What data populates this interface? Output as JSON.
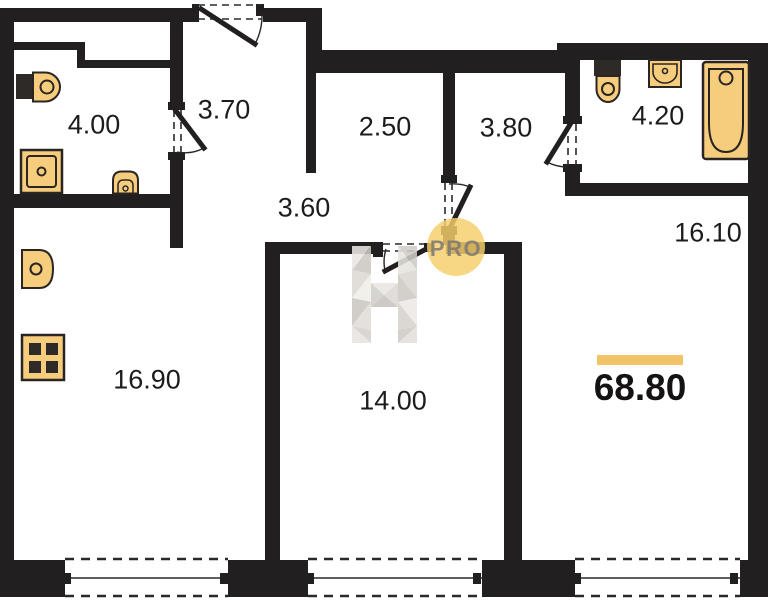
{
  "plan": {
    "title": "apartment-floor-plan",
    "total_area": {
      "value": "68.80"
    },
    "watermark": {
      "letter": "H",
      "badge": "PRO"
    },
    "rooms": [
      {
        "name": "bathroom",
        "area": "4.00"
      },
      {
        "name": "hallway",
        "area": "3.70"
      },
      {
        "name": "corridor",
        "area": "2.50"
      },
      {
        "name": "entry",
        "area": "3.80"
      },
      {
        "name": "bathroom-2",
        "area": "4.20"
      },
      {
        "name": "living-room",
        "area": "16.10"
      },
      {
        "name": "inner-hall",
        "area": "3.60"
      },
      {
        "name": "kitchen-living",
        "area": "16.90"
      },
      {
        "name": "bedroom",
        "area": "14.00"
      }
    ],
    "fixtures": [
      "toilet",
      "washing-machine",
      "sink",
      "kitchen-sink",
      "stove",
      "toilet-2",
      "sink-2",
      "bathtub"
    ],
    "colors": {
      "wall": "#221f20",
      "fixture_fill": "#f5cd7c",
      "fixture_stroke": "#2a2522",
      "accent_bar": "#f2c468",
      "watermark_circle": "#f6cf6b",
      "watermark_text": "#7d7873",
      "label": "#1d1b1c"
    }
  }
}
